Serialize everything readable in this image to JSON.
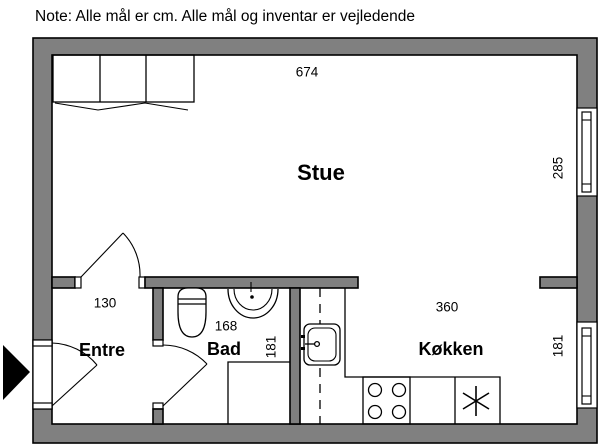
{
  "note": "Note: Alle mål er cm. Alle mål og inventar er vejledende",
  "rooms": {
    "stue": "Stue",
    "entre": "Entre",
    "bad": "Bad",
    "kokken": "Køkken"
  },
  "dimensions_cm": {
    "stue_width": "674",
    "stue_window_height": "285",
    "entre_door_width": "130",
    "bad_width": "168",
    "bad_depth": "181",
    "kokken_width": "360",
    "kokken_window_width": "181"
  },
  "colors": {
    "wall_fill": "#808080",
    "line": "#000000",
    "background": "#ffffff"
  }
}
